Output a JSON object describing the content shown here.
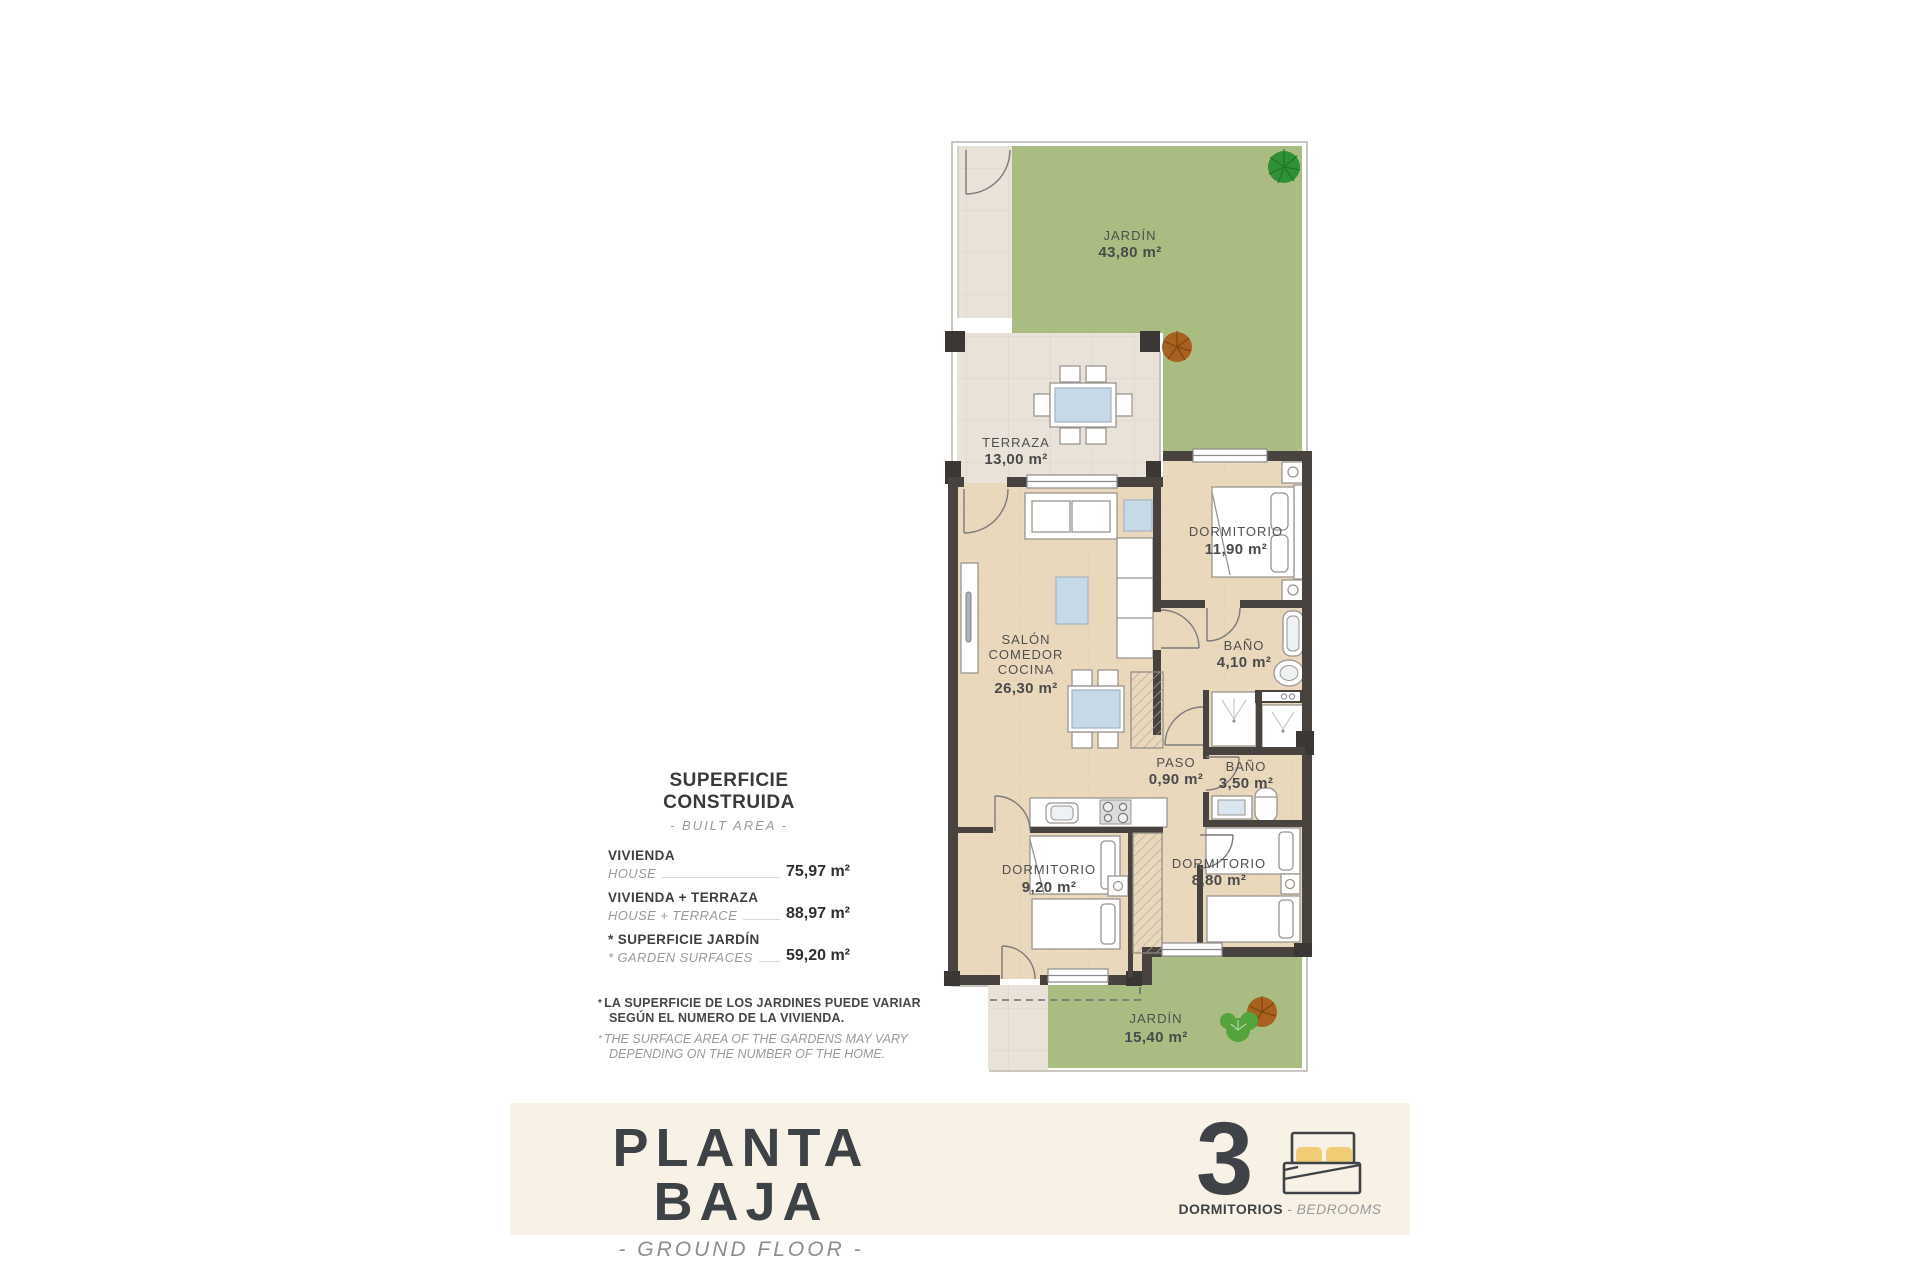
{
  "plan": {
    "garden_top": {
      "name": "JARDÍN",
      "area": "43,80 m²"
    },
    "terraza": {
      "name": "TERRAZA",
      "area": "13,00 m²"
    },
    "dorm_main": {
      "name": "DORMITORIO",
      "area": "11,90 m²"
    },
    "salon": {
      "line1": "SALÓN",
      "line2": "COMEDOR",
      "line3": "COCINA",
      "area": "26,30 m²"
    },
    "bano1": {
      "name": "BAÑO",
      "area": "4,10 m²"
    },
    "paso": {
      "name": "PASO",
      "area": "0,90 m²"
    },
    "bano2": {
      "name": "BAÑO",
      "area": "3,50 m²"
    },
    "dorm2": {
      "name": "DORMITORIO",
      "area": "9,20 m²"
    },
    "dorm3": {
      "name": "DORMITORIO",
      "area": "8,80 m²"
    },
    "garden_bottom": {
      "name": "JARDÍN",
      "area": "15,40 m²"
    }
  },
  "surface_panel": {
    "title": "SUPERFICIE CONSTRUIDA",
    "subtitle": "- BUILT AREA -",
    "rows": [
      {
        "label_es": "VIVIENDA",
        "label_en": "HOUSE",
        "value": "75,97 m²"
      },
      {
        "label_es": "VIVIENDA + TERRAZA",
        "label_en": "HOUSE + TERRACE",
        "value": "88,97 m²"
      },
      {
        "label_es": "* SUPERFICIE JARDÍN",
        "label_en": "* GARDEN SURFACES",
        "value": "59,20 m²"
      }
    ],
    "note_star": "*",
    "note_es_line1": "LA SUPERFICIE DE LOS JARDINES PUEDE VARIAR",
    "note_es_line2": "SEGÚN EL NUMERO DE LA VIVIENDA.",
    "note_en_line1": "THE SURFACE AREA OF THE GARDENS MAY VARY",
    "note_en_line2": "DEPENDING ON THE NUMBER OF THE HOME."
  },
  "footer": {
    "title": "PLANTA BAJA",
    "subtitle": "- GROUND FLOOR -",
    "bedrooms_count": "3",
    "label_es": "DORMITORIOS",
    "label_sep": " - ",
    "label_en": "BEDROOMS"
  },
  "colors": {
    "garden_green": "#a9bd82",
    "floor_tan": "#ead8bd",
    "paving": "#e9e2d9",
    "wall_dark": "#48433f",
    "footer_cream": "#f8f1e6",
    "text_dark": "#4d4d4d",
    "accent_gray": "#8f8f8f",
    "pillow_yellow": "#f0cc74",
    "glass_blue": "#c6d9e8"
  }
}
